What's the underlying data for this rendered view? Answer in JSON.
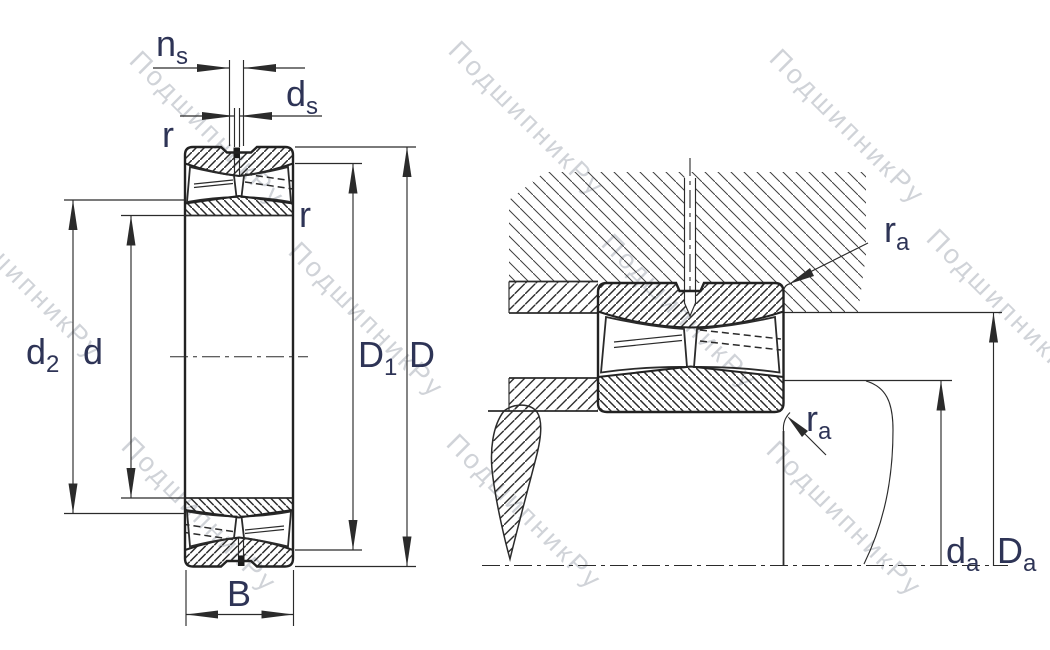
{
  "watermark": {
    "text": "ПодшипникРу"
  },
  "labels": {
    "ns": {
      "main": "n",
      "sub": "s"
    },
    "ds": {
      "main": "d",
      "sub": "s"
    },
    "r_outer": {
      "main": "r"
    },
    "r_inner": {
      "main": "r"
    },
    "d2": {
      "main": "d",
      "sub": "2"
    },
    "d": {
      "main": "d"
    },
    "D1": {
      "main": "D",
      "sub": "1"
    },
    "D": {
      "main": "D"
    },
    "B": {
      "main": "B"
    },
    "ra_housing": {
      "main": "r",
      "sub": "a"
    },
    "ra_shaft": {
      "main": "r",
      "sub": "a"
    },
    "da": {
      "main": "d",
      "sub": "a"
    },
    "Da": {
      "main": "D",
      "sub": "a"
    }
  }
}
